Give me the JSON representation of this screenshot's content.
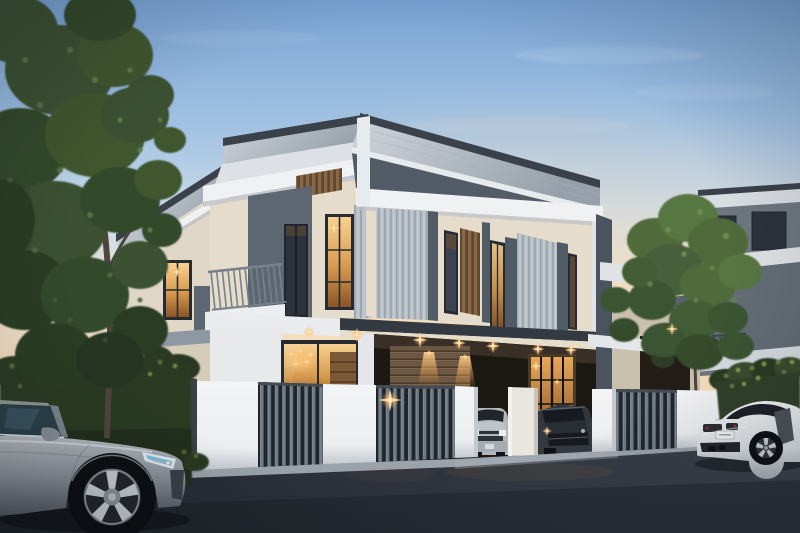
{
  "scene": {
    "type": "exterior-architectural-render",
    "time_of_day": "dusk",
    "aria_label": "Modern two-storey duplex house at dusk with warm lights, fence, trees and parked cars"
  },
  "palette": {
    "sky_top": "#79a4d6",
    "sky_mid": "#9fc0e2",
    "sky_pale": "#c9daea",
    "sky_cream": "#e9e0d4",
    "sky_horizon": "#f6dfc1",
    "roof_trim": "#3a414b",
    "roof_face_light": "#cfd5db",
    "roof_face_dark": "#97a0aa",
    "fascia_white": "#eff1f3",
    "wall_cream": "#e5dccb",
    "wall_cream_dark": "#d6cdbb",
    "accent_gray": "#5d6772",
    "siding_gray": "#b6bec6",
    "mullion_gray": "#515b65",
    "wood_louver": "#8a6845",
    "wood_dark": "#5f4730",
    "plank_wall": "#6b5742",
    "window_frame": "#262b31",
    "glass_warm": "#f2b96a",
    "glass_deep": "#8a5526",
    "glass_cool": "#3c4350",
    "railing_gray": "#76818c",
    "fence_white": "#eceef0",
    "fence_slat": "#6d7984",
    "fence_slat_bg": "#20252b",
    "hedge_green": "#2c3a24",
    "hedge_highlight": "#5a6c38",
    "tree_green": "#3a5130",
    "tree_green_light": "#567244",
    "tree_right_green": "#4f6b3b",
    "trunk_brown": "#4e463c",
    "asphalt_dark": "#20252d",
    "asphalt_light": "#3b424c",
    "curb_gray": "#9aa2aa",
    "flare_warm": "#ffd9a0",
    "glow_orange": "#ff9e3d",
    "car_silver": "#9aa0a7",
    "car_white": "#eceef0",
    "suv_dark": "#32373e",
    "neighbor_gray": "#6e7780"
  }
}
